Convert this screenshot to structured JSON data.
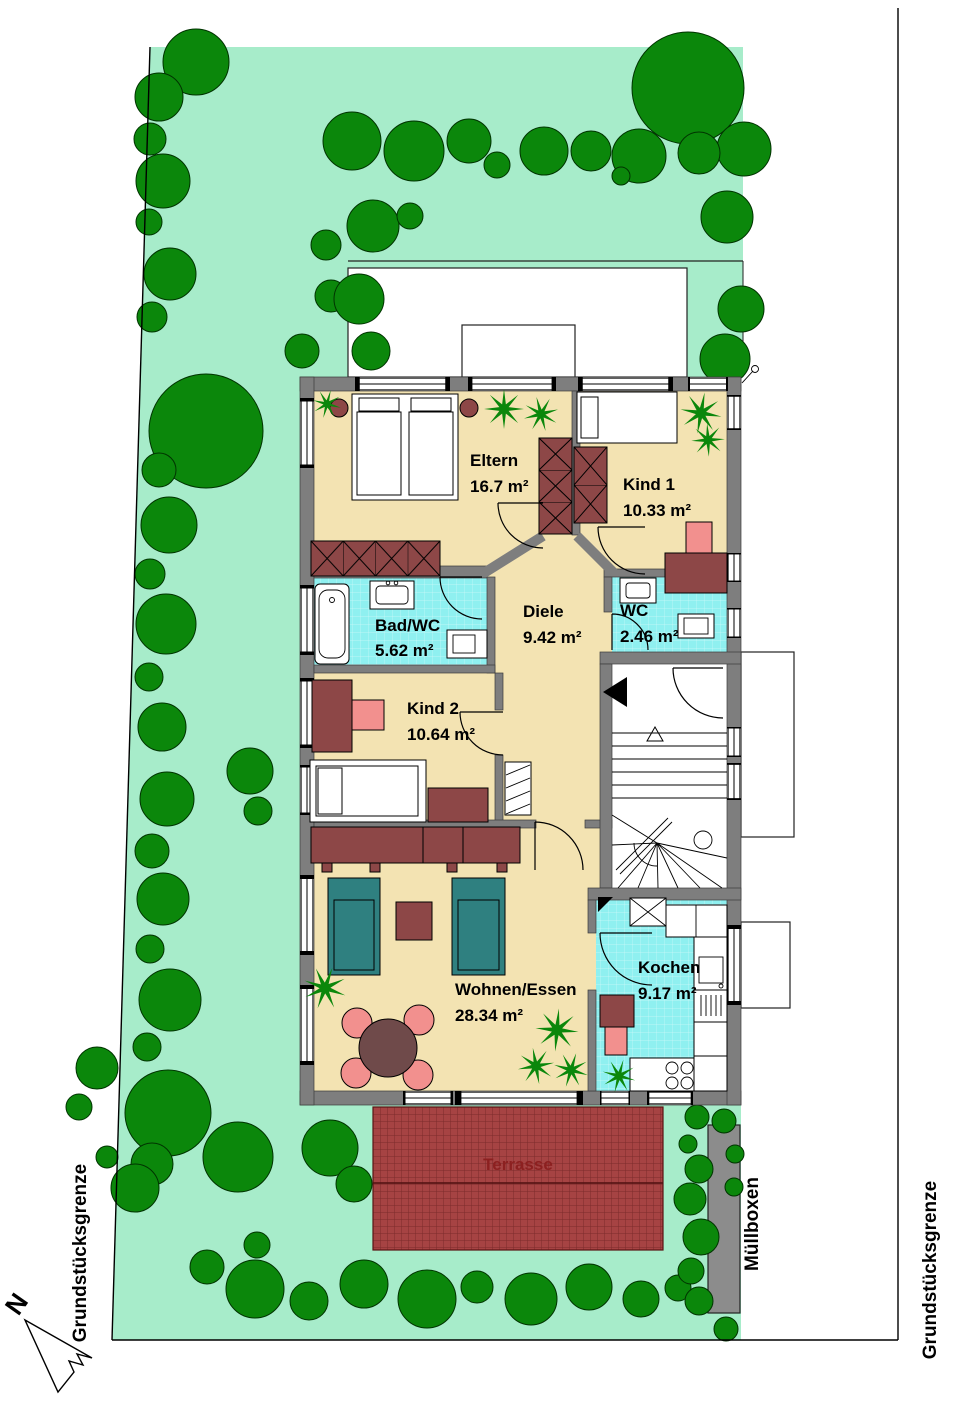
{
  "plan": {
    "rooms": [
      {
        "id": "eltern",
        "name": "Eltern",
        "area": "16.7 m²"
      },
      {
        "id": "kind1",
        "name": "Kind 1",
        "area": "10.33 m²"
      },
      {
        "id": "badwc",
        "name": "Bad/WC",
        "area": "5.62 m²"
      },
      {
        "id": "diele",
        "name": "Diele",
        "area": "9.42 m²"
      },
      {
        "id": "wc",
        "name": "WC",
        "area": "2.46 m²"
      },
      {
        "id": "kind2",
        "name": "Kind 2",
        "area": "10.64 m²"
      },
      {
        "id": "wohnen",
        "name": "Wohnen/Essen",
        "area": "28.34 m²"
      },
      {
        "id": "kochen",
        "name": "Kochen",
        "area": "9.17 m²"
      }
    ],
    "labels": {
      "terrace": "Terrasse",
      "boundary_left": "Grundstücksgrenze",
      "boundary_right": "Grundstücksgrenze",
      "trash": "Müllboxen",
      "north": "N"
    }
  },
  "colors": {
    "garden": "#A7ECCA",
    "tree": "#0B870B",
    "floor": "#F3E3B2",
    "wet": "#8FF0F0",
    "wall": "#7E7E7E",
    "furniture": "#8D4747",
    "chair": "#F2908E",
    "sofa": "#2F8080",
    "dining": "#6F4A4A",
    "terrace": "#A64343",
    "terrace-line": "#7C2B2B",
    "terrace-text": "#8C2020",
    "trash": "#8C8C8C"
  }
}
